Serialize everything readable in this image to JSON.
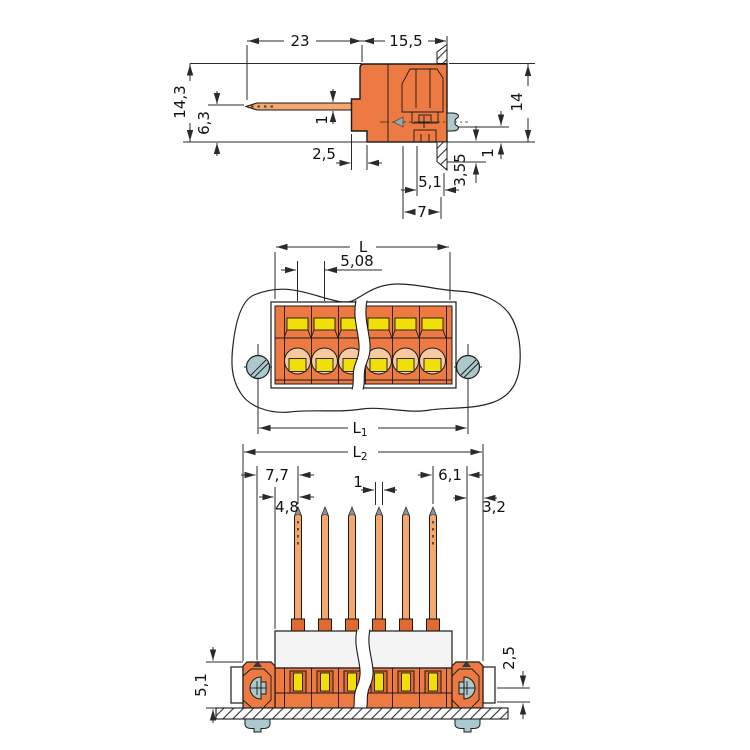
{
  "title": "terminal-block-connector-dimension-drawing",
  "colors": {
    "body_orange": "#EC7A42",
    "pin_copper": "#F5A86E",
    "contact_yellow": "#F2DF0A",
    "screw_teal": "#ABC9CC",
    "peach": "#F7C9A2",
    "band_gray": "#F4F4F4",
    "line": "#1a1a1a"
  },
  "side_view": {
    "w23": "23",
    "w155": "15,5",
    "h143": "14,3",
    "h63": "6,3",
    "pin_t": "1",
    "s25": "2,5",
    "s51": "5,1",
    "w7": "7",
    "h355": "3,55",
    "h1": "1",
    "h14": "14"
  },
  "front_view": {
    "L": "L",
    "pitch": "5,08",
    "L1m": "L",
    "L1s": "1",
    "L2m": "L",
    "L2s": "2"
  },
  "pin_view": {
    "d77": "7,7",
    "d48": "4,8",
    "d1": "1",
    "d61": "6,1",
    "d32": "3,2",
    "d51": "5,1",
    "d25": "2,5"
  }
}
